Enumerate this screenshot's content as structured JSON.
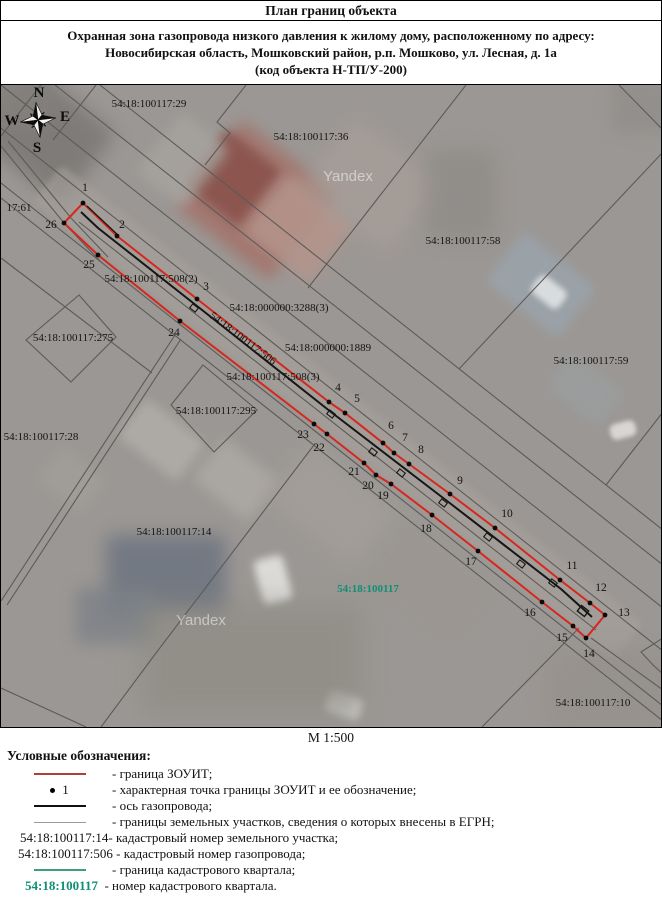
{
  "title": "План границ объекта",
  "subtitle": {
    "line1": "Охранная зона газопровода низкого давления к жилому дому, расположенному по адресу:",
    "line2": "Новосибирская область, Мошковский район, р.п. Мошково, ул. Лесная, д. 1а",
    "line3": "(код объекта Н-ТП/У-200)"
  },
  "scale_label": "М 1:500",
  "legend": {
    "heading": "Условные обозначения:",
    "zouit_label": "- граница ЗОУИТ;",
    "point_symbol": "1",
    "point_label": "- характерная точка границы ЗОУИТ и ее обозначение;",
    "axis_label": "- ось газопровода;",
    "egrn_label": "- границы земельных участков, сведения о которых внесены в ЕГРН;",
    "parcel_number": "54:18:100117:14-",
    "parcel_number_desc": "кадастровый номер земельного участка;",
    "pipe_number": "54:18:100117:506 -",
    "pipe_number_desc": "кадастровый номер газопровода;",
    "quarter_line_label": "- граница кадастрового квартала;",
    "quarter_number": "54:18:100117",
    "quarter_number_desc": "- номер кадастрового квартала."
  },
  "map": {
    "colors": {
      "boundary": "#d7271d",
      "axis": "#161616",
      "parcel_line": "#5b5b58",
      "label": "#141414",
      "quarter": "#0f8f74",
      "watermark": "rgba(255,255,255,0.5)"
    },
    "compass": {
      "n": "N",
      "e": "E",
      "s": "S",
      "w": "W",
      "cx": 37,
      "cy": 120
    },
    "watermarks": [
      {
        "text": "Yandex",
        "x": 347,
        "y": 181
      },
      {
        "text": "Yandex",
        "x": 200,
        "y": 625
      }
    ],
    "labels": [
      {
        "text": "54:18:100117:29",
        "x": 148,
        "y": 107
      },
      {
        "text": "54:18:100117:36",
        "x": 310,
        "y": 140
      },
      {
        "text": "54:18:100117:58",
        "x": 462,
        "y": 244
      },
      {
        "text": "54:18:100117:59",
        "x": 590,
        "y": 364
      },
      {
        "text": "17:61",
        "x": 18,
        "y": 211
      },
      {
        "text": "54:18:100117:508(2)",
        "x": 150,
        "y": 282
      },
      {
        "text": "54:18:000000:3288(3)",
        "x": 278,
        "y": 311
      },
      {
        "text": "54:18:000000:1889",
        "x": 327,
        "y": 351
      },
      {
        "text": "54:18:100117:508(3)",
        "x": 272,
        "y": 380
      },
      {
        "text": "54:18:100117:506",
        "x": 240,
        "y": 341,
        "rot": 37
      },
      {
        "text": "54:18:100117:275",
        "x": 72,
        "y": 341
      },
      {
        "text": "54:18:100117:295",
        "x": 215,
        "y": 414
      },
      {
        "text": "54:18:100117:28",
        "x": 40,
        "y": 440
      },
      {
        "text": "54:18:100117:14",
        "x": 173,
        "y": 535
      },
      {
        "text": "54:18:100117:10",
        "x": 592,
        "y": 706
      },
      {
        "text": "54:18:100117",
        "x": 367,
        "y": 592,
        "green": true
      }
    ],
    "points": [
      {
        "n": "1",
        "x": 82,
        "y": 203,
        "lx": 84,
        "ly": 191
      },
      {
        "n": "2",
        "x": 116,
        "y": 236,
        "lx": 121,
        "ly": 228
      },
      {
        "n": "3",
        "x": 196,
        "y": 299,
        "lx": 205,
        "ly": 290
      },
      {
        "n": "4",
        "x": 328,
        "y": 402,
        "lx": 337,
        "ly": 391
      },
      {
        "n": "5",
        "x": 344,
        "y": 413,
        "lx": 356,
        "ly": 402
      },
      {
        "n": "6",
        "x": 382,
        "y": 443,
        "lx": 390,
        "ly": 429
      },
      {
        "n": "7",
        "x": 393,
        "y": 453,
        "lx": 404,
        "ly": 441
      },
      {
        "n": "8",
        "x": 408,
        "y": 464,
        "lx": 420,
        "ly": 453
      },
      {
        "n": "9",
        "x": 449,
        "y": 494,
        "lx": 459,
        "ly": 484
      },
      {
        "n": "10",
        "x": 494,
        "y": 528,
        "lx": 506,
        "ly": 517
      },
      {
        "n": "11",
        "x": 559,
        "y": 580,
        "lx": 571,
        "ly": 569
      },
      {
        "n": "12",
        "x": 589,
        "y": 603,
        "lx": 600,
        "ly": 591
      },
      {
        "n": "13",
        "x": 604,
        "y": 615,
        "lx": 623,
        "ly": 616
      },
      {
        "n": "14",
        "x": 585,
        "y": 638,
        "lx": 588,
        "ly": 657
      },
      {
        "n": "15",
        "x": 572,
        "y": 626,
        "lx": 561,
        "ly": 641
      },
      {
        "n": "16",
        "x": 541,
        "y": 602,
        "lx": 529,
        "ly": 616
      },
      {
        "n": "17",
        "x": 477,
        "y": 551,
        "lx": 470,
        "ly": 565
      },
      {
        "n": "18",
        "x": 431,
        "y": 515,
        "lx": 425,
        "ly": 532
      },
      {
        "n": "19",
        "x": 390,
        "y": 484,
        "lx": 382,
        "ly": 499
      },
      {
        "n": "20",
        "x": 375,
        "y": 475,
        "lx": 367,
        "ly": 489
      },
      {
        "n": "21",
        "x": 363,
        "y": 463,
        "lx": 353,
        "ly": 475
      },
      {
        "n": "22",
        "x": 326,
        "y": 434,
        "lx": 318,
        "ly": 451
      },
      {
        "n": "23",
        "x": 313,
        "y": 424,
        "lx": 302,
        "ly": 438
      },
      {
        "n": "24",
        "x": 179,
        "y": 321,
        "lx": 173,
        "ly": 336
      },
      {
        "n": "25",
        "x": 97,
        "y": 255,
        "lx": 88,
        "ly": 268
      },
      {
        "n": "26",
        "x": 63,
        "y": 223,
        "lx": 50,
        "ly": 228
      }
    ],
    "axis_path": "M80,212 L97,228 L196,306 L330,412 L450,504 L560,589 L591,617",
    "axis_start_twin": "M86,206 L118,236",
    "axis_markers": [
      [
        193,
        308
      ],
      [
        330,
        414
      ],
      [
        372,
        452
      ],
      [
        400,
        473
      ],
      [
        442,
        503
      ],
      [
        487,
        537
      ],
      [
        520,
        564
      ],
      [
        552,
        583
      ]
    ],
    "end_marker": [
      582,
      611
    ],
    "parcel_paths": [
      "M99,85 L662,530",
      "M54,85 L662,565",
      "M0,85 L662,608",
      "M0,128 L662,651",
      "M78,222 L595,630",
      "M0,183 L662,706",
      "M0,198 L662,721",
      "M0,258 L151,373",
      "M40,85 L0,136",
      "M95,85 L52,140",
      "M245,85 L216,122 L229,133 L204,165",
      "M465,85 L307,288",
      "M618,85 L662,130",
      "M662,152 L458,369",
      "M662,412 L605,485",
      "M0,146 L63,223 L100,262",
      "M7,141 L70,218 L107,257",
      "M174,335 L0,601",
      "M180,339 L6,605",
      "M313,445 L155,653 L100,727",
      "M578,628 L481,727",
      "M590,638 L662,690",
      "M662,638 L640,652 L652,665 L662,674",
      "M0,688 L85,727",
      "M78,295 L115,337 L70,382 L25,340 Z",
      "M202,365 L256,410 L213,452 L170,405 Z"
    ],
    "patches": [
      {
        "x": 45,
        "y": 135,
        "w": 110,
        "h": 90,
        "rot": 38,
        "c": "#787572",
        "b": 9,
        "o": 0.8
      },
      {
        "x": 15,
        "y": 100,
        "w": 70,
        "h": 60,
        "rot": 0,
        "c": "#84817d",
        "b": 8,
        "o": 0.8
      },
      {
        "x": 337,
        "y": 412,
        "w": 740,
        "h": 46,
        "rot": 38.3,
        "c": "#a8a29c",
        "b": 3,
        "o": 0.55
      },
      {
        "x": 255,
        "y": 200,
        "w": 120,
        "h": 110,
        "rot": 38,
        "c": "#a3746c",
        "b": 7,
        "o": 0.9
      },
      {
        "x": 232,
        "y": 178,
        "w": 70,
        "h": 70,
        "rot": 38,
        "c": "#8a534c",
        "b": 5,
        "o": 0.9
      },
      {
        "x": 298,
        "y": 228,
        "w": 85,
        "h": 75,
        "rot": 38,
        "c": "#b5958c",
        "b": 7,
        "o": 0.85
      },
      {
        "x": 370,
        "y": 185,
        "w": 110,
        "h": 90,
        "rot": 38,
        "c": "#a99f99",
        "b": 10,
        "o": 0.7
      },
      {
        "x": 182,
        "y": 160,
        "w": 60,
        "h": 75,
        "rot": 38,
        "c": "#a7a4a0",
        "b": 6,
        "o": 0.8
      },
      {
        "x": 540,
        "y": 285,
        "w": 92,
        "h": 64,
        "rot": 38,
        "c": "#9aa3aa",
        "b": 5,
        "o": 0.9
      },
      {
        "x": 548,
        "y": 292,
        "w": 34,
        "h": 22,
        "rot": 38,
        "c": "#dfe3e5",
        "b": 3,
        "o": 0.9
      },
      {
        "x": 585,
        "y": 390,
        "w": 70,
        "h": 46,
        "rot": 38,
        "c": "#9aa0a3",
        "b": 7,
        "o": 0.6
      },
      {
        "x": 622,
        "y": 430,
        "w": 26,
        "h": 16,
        "rot": -15,
        "c": "#dedddb",
        "b": 2,
        "o": 0.9
      },
      {
        "x": 460,
        "y": 195,
        "w": 70,
        "h": 90,
        "rot": 0,
        "c": "#8d8a86",
        "b": 10,
        "o": 0.7
      },
      {
        "x": 160,
        "y": 440,
        "w": 75,
        "h": 48,
        "rot": 38,
        "c": "#b2aeaa",
        "b": 5,
        "o": 0.8
      },
      {
        "x": 70,
        "y": 480,
        "w": 55,
        "h": 42,
        "rot": 38,
        "c": "#a29e99",
        "b": 6,
        "o": 0.8
      },
      {
        "x": 235,
        "y": 480,
        "w": 70,
        "h": 52,
        "rot": 38,
        "c": "#aeaaa5",
        "b": 6,
        "o": 0.8
      },
      {
        "x": 330,
        "y": 505,
        "w": 110,
        "h": 70,
        "rot": 38,
        "c": "#a5a09a",
        "b": 11,
        "o": 0.7
      },
      {
        "x": 165,
        "y": 575,
        "w": 120,
        "h": 80,
        "rot": 0,
        "c": "#6d7480",
        "b": 9,
        "o": 0.85
      },
      {
        "x": 115,
        "y": 615,
        "w": 80,
        "h": 55,
        "rot": 0,
        "c": "#7d8187",
        "b": 8,
        "o": 0.8
      },
      {
        "x": 272,
        "y": 580,
        "w": 30,
        "h": 46,
        "rot": -15,
        "c": "#e2e2df",
        "b": 4,
        "o": 0.9
      },
      {
        "x": 343,
        "y": 705,
        "w": 36,
        "h": 22,
        "rot": 20,
        "c": "#d7d6d2",
        "b": 4,
        "o": 0.8
      },
      {
        "x": 250,
        "y": 660,
        "w": 220,
        "h": 110,
        "rot": 0,
        "c": "#8e8c83",
        "b": 14,
        "o": 0.7
      },
      {
        "x": 610,
        "y": 690,
        "w": 130,
        "h": 80,
        "rot": 0,
        "c": "#95908a",
        "b": 12,
        "o": 0.7
      },
      {
        "x": 640,
        "y": 105,
        "w": 60,
        "h": 55,
        "rot": 0,
        "c": "#8f8c89",
        "b": 8,
        "o": 0.7
      },
      {
        "x": 430,
        "y": 585,
        "w": 100,
        "h": 60,
        "rot": 38,
        "c": "#9b968f",
        "b": 10,
        "o": 0.6
      }
    ]
  }
}
